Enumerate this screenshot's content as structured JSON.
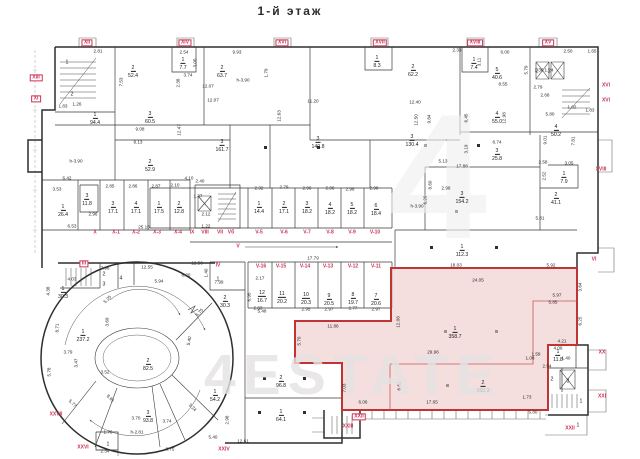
{
  "title": "1-й этаж",
  "watermark": {
    "big": "4",
    "main": "4ESTATE"
  },
  "colors": {
    "wall": "#2f2f2f",
    "highlight_fill": "#eec9c9",
    "highlight_stroke": "#c03434",
    "section_label": "#cb3355",
    "watermark": "#e4e2e2"
  },
  "rooms": [
    {
      "n": "1",
      "a": "",
      "x": 67,
      "y": 60
    },
    {
      "n": "2",
      "a": "",
      "x": 72,
      "y": 92
    },
    {
      "n": "2",
      "a": "52.4",
      "x": 133,
      "y": 68
    },
    {
      "n": "1",
      "a": "7.7",
      "x": 183,
      "y": 60
    },
    {
      "n": "2",
      "a": "63.7",
      "x": 222,
      "y": 68
    },
    {
      "n": "1",
      "a": "8.3",
      "x": 377,
      "y": 58
    },
    {
      "n": "2",
      "a": "62.2",
      "x": 413,
      "y": 67
    },
    {
      "n": "1",
      "a": "7.4",
      "x": 474,
      "y": 60
    },
    {
      "n": "5",
      "a": "40.6",
      "x": 497,
      "y": 70
    },
    {
      "n": "2",
      "a": "",
      "x": 537,
      "y": 69
    },
    {
      "n": "1",
      "a": "",
      "x": 549,
      "y": 69
    },
    {
      "n": "1",
      "a": "94.4",
      "x": 95,
      "y": 115
    },
    {
      "n": "3",
      "a": "60.5",
      "x": 150,
      "y": 114
    },
    {
      "n": "2",
      "a": "52.9",
      "x": 150,
      "y": 162
    },
    {
      "n": "3",
      "a": "161.7",
      "x": 222,
      "y": 142
    },
    {
      "n": "3",
      "a": "140.8",
      "x": 318,
      "y": 139
    },
    {
      "n": "3",
      "a": "130.4",
      "x": 412,
      "y": 137
    },
    {
      "n": "4",
      "a": "55.0",
      "x": 497,
      "y": 114
    },
    {
      "n": "3",
      "a": "25.8",
      "x": 497,
      "y": 151
    },
    {
      "n": "4",
      "a": "50.2",
      "x": 556,
      "y": 127
    },
    {
      "n": "1",
      "a": "7.9",
      "x": 564,
      "y": 174
    },
    {
      "n": "2",
      "a": "41.1",
      "x": 556,
      "y": 195
    },
    {
      "n": "3",
      "a": "154.2",
      "x": 462,
      "y": 194
    },
    {
      "n": "1",
      "a": "112.3",
      "x": 462,
      "y": 247
    },
    {
      "n": "1",
      "a": "26.4",
      "x": 63,
      "y": 207
    },
    {
      "n": "3",
      "a": "11.8",
      "x": 87,
      "y": 196
    },
    {
      "n": "3",
      "a": "17.1",
      "x": 113,
      "y": 204
    },
    {
      "n": "4",
      "a": "17.1",
      "x": 136,
      "y": 204
    },
    {
      "n": "1",
      "a": "17.5",
      "x": 159,
      "y": 204
    },
    {
      "n": "2",
      "a": "12.8",
      "x": 179,
      "y": 204
    },
    {
      "n": "1",
      "a": "14.4",
      "x": 259,
      "y": 204
    },
    {
      "n": "2",
      "a": "17.1",
      "x": 284,
      "y": 204
    },
    {
      "n": "3",
      "a": "18.2",
      "x": 307,
      "y": 204
    },
    {
      "n": "4",
      "a": "18.2",
      "x": 330,
      "y": 205
    },
    {
      "n": "5",
      "a": "18.2",
      "x": 352,
      "y": 205
    },
    {
      "n": "6",
      "a": "18.4",
      "x": 376,
      "y": 206
    },
    {
      "n": "12",
      "a": "16.7",
      "x": 262,
      "y": 293
    },
    {
      "n": "11",
      "a": "20.2",
      "x": 282,
      "y": 294
    },
    {
      "n": "10",
      "a": "20.3",
      "x": 306,
      "y": 295
    },
    {
      "n": "9",
      "a": "20.5",
      "x": 329,
      "y": 296
    },
    {
      "n": "8",
      "a": "19.7",
      "x": 353,
      "y": 295
    },
    {
      "n": "7",
      "a": "20.6",
      "x": 376,
      "y": 296
    },
    {
      "n": "1",
      "a": "",
      "x": 218,
      "y": 277
    },
    {
      "n": "2",
      "a": "30.3",
      "x": 225,
      "y": 298
    },
    {
      "n": "1",
      "a": "30.3",
      "x": 63,
      "y": 289
    },
    {
      "n": "2",
      "a": "",
      "x": 104,
      "y": 272
    },
    {
      "n": "3",
      "a": "",
      "x": 104,
      "y": 282
    },
    {
      "n": "4",
      "a": "",
      "x": 121,
      "y": 276
    },
    {
      "n": "1",
      "a": "237.2",
      "x": 83,
      "y": 332
    },
    {
      "n": "2",
      "a": "82.5",
      "x": 148,
      "y": 361
    },
    {
      "n": "3",
      "a": "93.8",
      "x": 148,
      "y": 413
    },
    {
      "n": "1",
      "a": "54.2",
      "x": 215,
      "y": 392
    },
    {
      "n": "2",
      "a": "96.8",
      "x": 281,
      "y": 378
    },
    {
      "n": "1",
      "a": "64.1",
      "x": 281,
      "y": 412
    },
    {
      "n": "1",
      "a": "",
      "x": 108,
      "y": 442
    },
    {
      "n": "1",
      "a": "358.7",
      "x": 455,
      "y": 329
    },
    {
      "n": "2",
      "a": "160.3",
      "x": 483,
      "y": 383
    },
    {
      "n": "1",
      "a": "11.8",
      "x": 558,
      "y": 352
    },
    {
      "n": "2",
      "a": "",
      "x": 552,
      "y": 377
    },
    {
      "n": "3",
      "a": "",
      "x": 568,
      "y": 379
    },
    {
      "n": "1",
      "a": "",
      "x": 581,
      "y": 399
    },
    {
      "n": "1",
      "a": "",
      "x": 578,
      "y": 423
    }
  ],
  "sections": [
    {
      "t": "XII",
      "x": 87,
      "y": 43,
      "b": true
    },
    {
      "t": "XIV",
      "x": 185,
      "y": 43,
      "b": true
    },
    {
      "t": "XVI",
      "x": 282,
      "y": 43,
      "b": true
    },
    {
      "t": "XVII",
      "x": 380,
      "y": 43,
      "b": true
    },
    {
      "t": "XVIII",
      "x": 475,
      "y": 43,
      "b": true
    },
    {
      "t": "XV",
      "x": 548,
      "y": 43,
      "b": true
    },
    {
      "t": "XIII",
      "x": 36,
      "y": 78,
      "b": true
    },
    {
      "t": "XI",
      "x": 36,
      "y": 99,
      "b": true
    },
    {
      "t": "XVI",
      "x": 606,
      "y": 86
    },
    {
      "t": "XVI",
      "x": 606,
      "y": 101
    },
    {
      "t": "XVIII",
      "x": 601,
      "y": 170
    },
    {
      "t": "VI",
      "x": 594,
      "y": 260
    },
    {
      "t": "XX",
      "x": 602,
      "y": 353
    },
    {
      "t": "XXI",
      "x": 602,
      "y": 397
    },
    {
      "t": "XXII",
      "x": 570,
      "y": 429
    },
    {
      "t": "XXII",
      "x": 359,
      "y": 417,
      "b": true
    },
    {
      "t": "XXIII",
      "x": 348,
      "y": 427
    },
    {
      "t": "XXIV",
      "x": 224,
      "y": 450
    },
    {
      "t": "XXVI",
      "x": 83,
      "y": 448
    },
    {
      "t": "XXVII",
      "x": 56,
      "y": 415
    },
    {
      "t": "III",
      "x": 84,
      "y": 264,
      "b": true
    },
    {
      "t": "IV",
      "x": 218,
      "y": 266
    },
    {
      "t": "X",
      "x": 95,
      "y": 233
    },
    {
      "t": "X-1",
      "x": 116,
      "y": 233
    },
    {
      "t": "X-2",
      "x": 136,
      "y": 233
    },
    {
      "t": "X-3",
      "x": 157,
      "y": 233
    },
    {
      "t": "X-4",
      "x": 178,
      "y": 233
    },
    {
      "t": "IX",
      "x": 192,
      "y": 233
    },
    {
      "t": "VIII",
      "x": 205,
      "y": 233
    },
    {
      "t": "VII",
      "x": 220,
      "y": 233
    },
    {
      "t": "Vб",
      "x": 231,
      "y": 233
    },
    {
      "t": "V-5",
      "x": 259,
      "y": 233
    },
    {
      "t": "V-6",
      "x": 284,
      "y": 233
    },
    {
      "t": "V-7",
      "x": 307,
      "y": 233
    },
    {
      "t": "V-8",
      "x": 330,
      "y": 233
    },
    {
      "t": "V-9",
      "x": 352,
      "y": 233
    },
    {
      "t": "V-10",
      "x": 375,
      "y": 233
    },
    {
      "t": "V",
      "x": 238,
      "y": 247
    },
    {
      "t": "V-16",
      "x": 261,
      "y": 267
    },
    {
      "t": "V-15",
      "x": 281,
      "y": 267
    },
    {
      "t": "V-14",
      "x": 305,
      "y": 267
    },
    {
      "t": "V-13",
      "x": 328,
      "y": 267
    },
    {
      "t": "V-12",
      "x": 353,
      "y": 267
    },
    {
      "t": "V-11",
      "x": 376,
      "y": 267
    }
  ],
  "dimensions": [
    {
      "t": "2.81",
      "x": 98,
      "y": 52
    },
    {
      "t": "2.54",
      "x": 184,
      "y": 53
    },
    {
      "t": "9.93",
      "x": 237,
      "y": 53
    },
    {
      "t": "2.33",
      "x": 457,
      "y": 51
    },
    {
      "t": "6.00",
      "x": 505,
      "y": 53
    },
    {
      "t": "2.50",
      "x": 568,
      "y": 52
    },
    {
      "t": "1.65",
      "x": 592,
      "y": 52
    },
    {
      "t": "7.53",
      "x": 122,
      "y": 82,
      "r": -90
    },
    {
      "t": "3.05",
      "x": 196,
      "y": 63,
      "r": -90
    },
    {
      "t": "1.79",
      "x": 267,
      "y": 73,
      "r": -90
    },
    {
      "t": "3.74",
      "x": 188,
      "y": 76
    },
    {
      "t": "2.38",
      "x": 179,
      "y": 83,
      "r": -90
    },
    {
      "t": "5.79",
      "x": 527,
      "y": 70,
      "r": -90
    },
    {
      "t": "3.11",
      "x": 480,
      "y": 62,
      "r": -90
    },
    {
      "t": "1.36",
      "x": 539,
      "y": 71
    },
    {
      "t": "1.24",
      "x": 549,
      "y": 71
    },
    {
      "t": "12.07",
      "x": 208,
      "y": 87
    },
    {
      "t": "12.07",
      "x": 213,
      "y": 101
    },
    {
      "t": "11.20",
      "x": 313,
      "y": 102
    },
    {
      "t": "12.40",
      "x": 415,
      "y": 103
    },
    {
      "t": "8.55",
      "x": 503,
      "y": 85
    },
    {
      "t": "2.79",
      "x": 538,
      "y": 88
    },
    {
      "t": "2.68",
      "x": 545,
      "y": 96
    },
    {
      "t": "1.02",
      "x": 572,
      "y": 108
    },
    {
      "t": "1.83",
      "x": 590,
      "y": 111
    },
    {
      "t": "5.80",
      "x": 550,
      "y": 115
    },
    {
      "t": "1.83",
      "x": 63,
      "y": 107
    },
    {
      "t": "1.26",
      "x": 77,
      "y": 105
    },
    {
      "t": "9.08",
      "x": 140,
      "y": 130
    },
    {
      "t": "9.13",
      "x": 138,
      "y": 143
    },
    {
      "t": "12.47",
      "x": 180,
      "y": 130,
      "r": -90
    },
    {
      "t": "12.63",
      "x": 280,
      "y": 116,
      "r": -90
    },
    {
      "t": "12.50",
      "x": 417,
      "y": 120,
      "r": -90
    },
    {
      "t": "12.98",
      "x": 505,
      "y": 118,
      "r": -90
    },
    {
      "t": "h-3.90",
      "x": 76,
      "y": 162
    },
    {
      "t": "h-3.90",
      "x": 243,
      "y": 81
    },
    {
      "t": "h-3.90",
      "x": 417,
      "y": 207
    },
    {
      "t": "h-2.81",
      "x": 137,
      "y": 433
    },
    {
      "t": "9.84",
      "x": 430,
      "y": 119,
      "r": -90
    },
    {
      "t": "6.45",
      "x": 467,
      "y": 118,
      "r": -90
    },
    {
      "t": "8.74",
      "x": 497,
      "y": 143
    },
    {
      "t": "3.19",
      "x": 467,
      "y": 149,
      "r": -90
    },
    {
      "t": "9.01",
      "x": 546,
      "y": 140,
      "r": -90
    },
    {
      "t": "7.81",
      "x": 574,
      "y": 141,
      "r": -90
    },
    {
      "t": "17.88",
      "x": 462,
      "y": 167
    },
    {
      "t": "2.58",
      "x": 543,
      "y": 163
    },
    {
      "t": "3.05",
      "x": 569,
      "y": 164
    },
    {
      "t": "2.52",
      "x": 545,
      "y": 176,
      "r": -90
    },
    {
      "t": "8.60",
      "x": 431,
      "y": 185,
      "r": -90
    },
    {
      "t": "5.81",
      "x": 540,
      "y": 219
    },
    {
      "t": "5.13",
      "x": 443,
      "y": 162
    },
    {
      "t": "2.98",
      "x": 446,
      "y": 189
    },
    {
      "t": "6.20",
      "x": 426,
      "y": 200,
      "r": -90
    },
    {
      "t": "6.42",
      "x": 67,
      "y": 179
    },
    {
      "t": "3.53",
      "x": 57,
      "y": 190
    },
    {
      "t": "2.96",
      "x": 93,
      "y": 215
    },
    {
      "t": "2.85",
      "x": 110,
      "y": 187
    },
    {
      "t": "2.86",
      "x": 133,
      "y": 187
    },
    {
      "t": "2.87",
      "x": 156,
      "y": 187
    },
    {
      "t": "2.10",
      "x": 175,
      "y": 186
    },
    {
      "t": "4.10",
      "x": 189,
      "y": 179
    },
    {
      "t": "25.16",
      "x": 144,
      "y": 228
    },
    {
      "t": "6.53",
      "x": 72,
      "y": 227
    },
    {
      "t": "2.32",
      "x": 259,
      "y": 189
    },
    {
      "t": "2.79",
      "x": 284,
      "y": 188
    },
    {
      "t": "2.96",
      "x": 307,
      "y": 189
    },
    {
      "t": "2.96",
      "x": 330,
      "y": 189
    },
    {
      "t": "2.96",
      "x": 350,
      "y": 190
    },
    {
      "t": "2.98",
      "x": 374,
      "y": 189
    },
    {
      "t": "2.40",
      "x": 200,
      "y": 182
    },
    {
      "t": "2.12",
      "x": 206,
      "y": 215
    },
    {
      "t": "1.37",
      "x": 198,
      "y": 197
    },
    {
      "t": "1.22",
      "x": 206,
      "y": 227
    },
    {
      "t": "12.56",
      "x": 197,
      "y": 264
    },
    {
      "t": "17.79",
      "x": 313,
      "y": 259
    },
    {
      "t": "2.17",
      "x": 260,
      "y": 279
    },
    {
      "t": "2.83",
      "x": 258,
      "y": 309
    },
    {
      "t": "2.95",
      "x": 306,
      "y": 310
    },
    {
      "t": "2.97",
      "x": 329,
      "y": 310
    },
    {
      "t": "2.77",
      "x": 353,
      "y": 309
    },
    {
      "t": "2.97",
      "x": 376,
      "y": 310
    },
    {
      "t": "6.95",
      "x": 250,
      "y": 297,
      "r": -90
    },
    {
      "t": "5.48",
      "x": 262,
      "y": 312
    },
    {
      "t": "7.98",
      "x": 105,
      "y": 269
    },
    {
      "t": "12.55",
      "x": 147,
      "y": 268
    },
    {
      "t": "4.03",
      "x": 72,
      "y": 280
    },
    {
      "t": "4.38",
      "x": 49,
      "y": 291,
      "r": -90
    },
    {
      "t": "5.94",
      "x": 159,
      "y": 282
    },
    {
      "t": "6.20",
      "x": 186,
      "y": 276
    },
    {
      "t": "7.99",
      "x": 219,
      "y": 283
    },
    {
      "t": "1.40",
      "x": 207,
      "y": 273,
      "r": -90
    },
    {
      "t": "5.25",
      "x": 108,
      "y": 300,
      "r": -45
    },
    {
      "t": "3.69",
      "x": 108,
      "y": 322,
      "r": -90
    },
    {
      "t": "8.71",
      "x": 58,
      "y": 328,
      "r": -90
    },
    {
      "t": "3.79",
      "x": 68,
      "y": 353
    },
    {
      "t": "3.52",
      "x": 105,
      "y": 373
    },
    {
      "t": "5.78",
      "x": 50,
      "y": 372,
      "r": -90
    },
    {
      "t": "3.47",
      "x": 77,
      "y": 363,
      "r": -90
    },
    {
      "t": "5.77",
      "x": 72,
      "y": 404,
      "r": 45
    },
    {
      "t": "8.61",
      "x": 110,
      "y": 399,
      "r": 45
    },
    {
      "t": "3.70",
      "x": 136,
      "y": 419
    },
    {
      "t": "3.74",
      "x": 167,
      "y": 422
    },
    {
      "t": "6.75",
      "x": 170,
      "y": 450
    },
    {
      "t": "2.34",
      "x": 105,
      "y": 452
    },
    {
      "t": "1.76",
      "x": 108,
      "y": 433
    },
    {
      "t": "5.40",
      "x": 190,
      "y": 341,
      "r": -80
    },
    {
      "t": "5.75",
      "x": 200,
      "y": 313,
      "r": -45
    },
    {
      "t": "3.24",
      "x": 192,
      "y": 408,
      "r": 45
    },
    {
      "t": "5.40",
      "x": 213,
      "y": 438
    },
    {
      "t": "2.98",
      "x": 228,
      "y": 420,
      "r": -90
    },
    {
      "t": "12.61",
      "x": 243,
      "y": 442
    },
    {
      "t": "18.03",
      "x": 456,
      "y": 266
    },
    {
      "t": "5.92",
      "x": 551,
      "y": 266
    },
    {
      "t": "24.05",
      "x": 478,
      "y": 281
    },
    {
      "t": "3.64",
      "x": 581,
      "y": 287,
      "r": -90
    },
    {
      "t": "5.97",
      "x": 557,
      "y": 296
    },
    {
      "t": "5.85",
      "x": 553,
      "y": 303
    },
    {
      "t": "6.25",
      "x": 581,
      "y": 321,
      "r": -90
    },
    {
      "t": "4.21",
      "x": 562,
      "y": 342
    },
    {
      "t": "4.06",
      "x": 558,
      "y": 349
    },
    {
      "t": "1.59",
      "x": 536,
      "y": 355
    },
    {
      "t": "29.96",
      "x": 433,
      "y": 353
    },
    {
      "t": "11.86",
      "x": 333,
      "y": 327
    },
    {
      "t": "5.70",
      "x": 300,
      "y": 341,
      "r": -90
    },
    {
      "t": "12.08",
      "x": 399,
      "y": 322,
      "r": -90
    },
    {
      "t": "6.61",
      "x": 400,
      "y": 386,
      "r": -90
    },
    {
      "t": "7.03",
      "x": 345,
      "y": 388,
      "r": -90
    },
    {
      "t": "6.06",
      "x": 363,
      "y": 403
    },
    {
      "t": "17.65",
      "x": 432,
      "y": 403
    },
    {
      "t": "1.73",
      "x": 527,
      "y": 398
    },
    {
      "t": "1.08",
      "x": 530,
      "y": 359
    },
    {
      "t": "2.54",
      "x": 547,
      "y": 367
    },
    {
      "t": "1.40",
      "x": 566,
      "y": 359
    },
    {
      "t": "5.80",
      "x": 533,
      "y": 413
    }
  ]
}
